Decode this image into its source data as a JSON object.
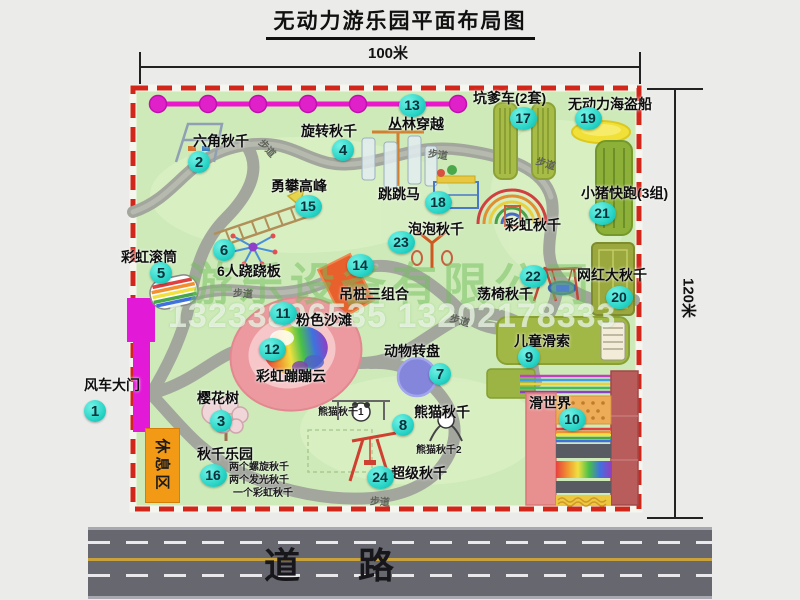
{
  "title": "无动力游乐园平面布局图",
  "dimensions": {
    "width": "100米",
    "height": "120米"
  },
  "watermark": {
    "company": "游乐设备有限公司",
    "phone": "13233806535 13202178333"
  },
  "road_label": "道 路",
  "rest_area_label": "休息区",
  "walkway_label": "步道",
  "walkway_positions": [
    {
      "x": 258,
      "y": 140,
      "rot": 48
    },
    {
      "x": 428,
      "y": 146,
      "rot": 8
    },
    {
      "x": 536,
      "y": 155,
      "rot": 18
    },
    {
      "x": 233,
      "y": 285,
      "rot": 4
    },
    {
      "x": 450,
      "y": 312,
      "rot": 16
    },
    {
      "x": 370,
      "y": 493,
      "rot": 4
    }
  ],
  "colors": {
    "park_green": "#cdeab8",
    "border_red": "#d3261a",
    "badge_cyan": "#27d4c6",
    "gate_magenta": "#e219d6",
    "zipline_magenta": "#e020c8",
    "rest_orange": "#f29a16",
    "road_gray": "#67676f"
  },
  "attractions": [
    {
      "num": "1",
      "label": "风车大门",
      "label_x": 84,
      "label_y": 375,
      "badge_x": 95,
      "badge_y": 411
    },
    {
      "num": "2",
      "label": "六角秋千",
      "label_x": 193,
      "label_y": 131,
      "badge_x": 199,
      "badge_y": 162
    },
    {
      "num": "3",
      "label": "樱花树",
      "label_x": 197,
      "label_y": 388,
      "badge_x": 221,
      "badge_y": 421
    },
    {
      "num": "4",
      "label": "旋转秋千",
      "label_x": 301,
      "label_y": 121,
      "badge_x": 343,
      "badge_y": 150
    },
    {
      "num": "5",
      "label": "彩虹滚筒",
      "label_x": 121,
      "label_y": 247,
      "badge_x": 161,
      "badge_y": 273
    },
    {
      "num": "6",
      "label": "6人跷跷板",
      "label_x": 217,
      "label_y": 261,
      "badge_x": 224,
      "badge_y": 250
    },
    {
      "num": "7",
      "label": "动物转盘",
      "label_x": 384,
      "label_y": 341,
      "badge_x": 440,
      "badge_y": 374
    },
    {
      "num": "8",
      "label": "熊猫秋千",
      "label_x": 414,
      "label_y": 402,
      "badge_x": 403,
      "badge_y": 425
    },
    {
      "num": "9",
      "label": "儿童滑索",
      "label_x": 514,
      "label_y": 331,
      "badge_x": 529,
      "badge_y": 357
    },
    {
      "num": "10",
      "label": "滑世界",
      "label_x": 529,
      "label_y": 393,
      "badge_x": 572,
      "badge_y": 419
    },
    {
      "num": "11",
      "label": "粉色沙滩",
      "label_x": 296,
      "label_y": 310,
      "badge_x": 283,
      "badge_y": 313
    },
    {
      "num": "12",
      "label": "彩虹蹦蹦云",
      "label_x": 256,
      "label_y": 366,
      "badge_x": 272,
      "badge_y": 349
    },
    {
      "num": "13",
      "label": "丛林穿越",
      "label_x": 388,
      "label_y": 114,
      "badge_x": 412,
      "badge_y": 105
    },
    {
      "num": "14",
      "label": "吊桩三组合",
      "label_x": 339,
      "label_y": 284,
      "badge_x": 360,
      "badge_y": 265
    },
    {
      "num": "15",
      "label": "勇攀高峰",
      "label_x": 271,
      "label_y": 176,
      "badge_x": 308,
      "badge_y": 206
    },
    {
      "num": "16",
      "label": "秋千乐园",
      "label_x": 197,
      "label_y": 444,
      "badge_x": 213,
      "badge_y": 475
    },
    {
      "num": "17",
      "label": "坑爹车(2套)",
      "label_x": 473,
      "label_y": 88,
      "badge_x": 523,
      "badge_y": 118
    },
    {
      "num": "18",
      "label": "跳跳马",
      "label_x": 378,
      "label_y": 184,
      "badge_x": 438,
      "badge_y": 202
    },
    {
      "num": "19",
      "label": "无动力海盗船",
      "label_x": 568,
      "label_y": 94,
      "badge_x": 588,
      "badge_y": 118
    },
    {
      "num": "20",
      "label": "网红大秋千",
      "label_x": 577,
      "label_y": 265,
      "badge_x": 619,
      "badge_y": 297
    },
    {
      "num": "21",
      "label": "小猪快跑(3组)",
      "label_x": 581,
      "label_y": 183,
      "badge_x": 602,
      "badge_y": 213
    },
    {
      "num": "22",
      "label": "荡椅秋千",
      "label_x": 477,
      "label_y": 284,
      "badge_x": 533,
      "badge_y": 276
    },
    {
      "num": "23",
      "label": "泡泡秋千",
      "label_x": 408,
      "label_y": 219,
      "badge_x": 401,
      "badge_y": 242
    },
    {
      "num": "24",
      "label": "超级秋千",
      "label_x": 391,
      "label_y": 463,
      "badge_x": 380,
      "badge_y": 477
    },
    {
      "num": "",
      "label": "彩虹秋千",
      "label_x": 505,
      "label_y": 215,
      "badge_x": 0,
      "badge_y": 0
    }
  ],
  "sub_labels": [
    {
      "text": "两个螺旋秋千",
      "x": 229,
      "y": 458
    },
    {
      "text": "两个发光秋千",
      "x": 229,
      "y": 471
    },
    {
      "text": "一个彩虹秋千",
      "x": 233,
      "y": 484
    },
    {
      "text": "熊猫秋千1",
      "x": 318,
      "y": 403
    },
    {
      "text": "熊猫秋千2",
      "x": 416,
      "y": 441
    }
  ]
}
